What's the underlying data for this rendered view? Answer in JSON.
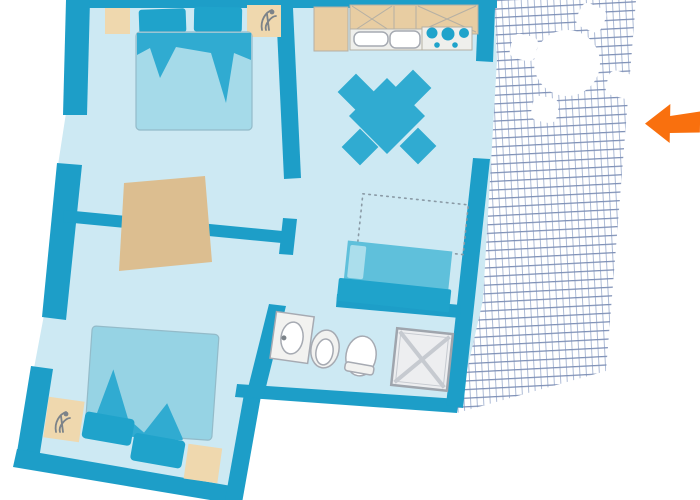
{
  "title": "apartment-floor-plan",
  "colors": {
    "wall": "#1D9EC8",
    "floor": "#CDE9F3",
    "furniture_dark": "#1FA3CB",
    "furniture_mid": "#30ABD1",
    "bed_blanket": "#A5DAE9",
    "bed2_blanket": "#96D3E4",
    "bed_outline": "#93BBC9",
    "sofa_back": "#5FC0DB",
    "sofa_light": "#ABDEEC",
    "beige_counter": "#E8CDA2",
    "beige_rug": "#DCBE90",
    "beige_nightstand": "#EFD8AE",
    "panel_fill": "#EFEFEC",
    "counter_stroke": "#B5B0A4",
    "grid_vertical": "#ADBBD6",
    "grid_horizontal": "#7E90B6",
    "fixture_fill": "#F2F2F0",
    "fixture_stroke": "#A6AAB2",
    "fixture_light": "#C6CAD0",
    "dashed_outline": "#8A9AA5",
    "glyph": "#7C8389",
    "arrow": "#F9700E",
    "white": "#FFFFFF"
  },
  "items": [
    "terrace-grid",
    "terrace-round-table",
    "terrace-chair",
    "double-bed-top",
    "pillow",
    "nightstand",
    "lamp-icon",
    "kitchen-counter",
    "cabinet-x-icon",
    "kitchen-sink",
    "stove-burners",
    "dining-table",
    "dining-chair",
    "hall-rug",
    "sofa-bed",
    "sofa-bed-fold-out-outline",
    "double-bed-bottom",
    "washbasin",
    "toilet",
    "bidet",
    "shower",
    "direction-arrow"
  ]
}
